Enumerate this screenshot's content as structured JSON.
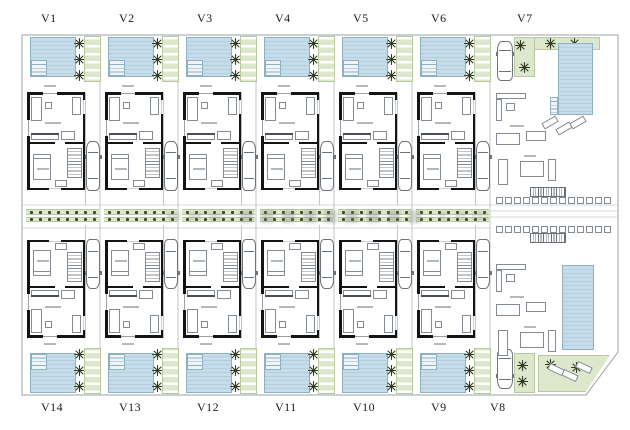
{
  "site": {
    "top_labels": [
      "V1",
      "V2",
      "V3",
      "V4",
      "V5",
      "V6",
      "V7"
    ],
    "bottom_labels": [
      "V14",
      "V13",
      "V12",
      "V11",
      "V10",
      "V9",
      "V8"
    ],
    "watermark": "www.■■■■■■■■■.com"
  },
  "colors": {
    "pool": "#c6dde9",
    "pool_stripe": "#b2d0e0",
    "pool_border": "#8fb0c2",
    "green": "#dde7cb",
    "green_border": "#b9c8a0",
    "wall": "#141414",
    "line": "#9aa0a6",
    "faint_line": "#c2c6ca",
    "label_color": "#1b1b1b",
    "plant": "#3c4628",
    "watermark_color": "#808080"
  }
}
